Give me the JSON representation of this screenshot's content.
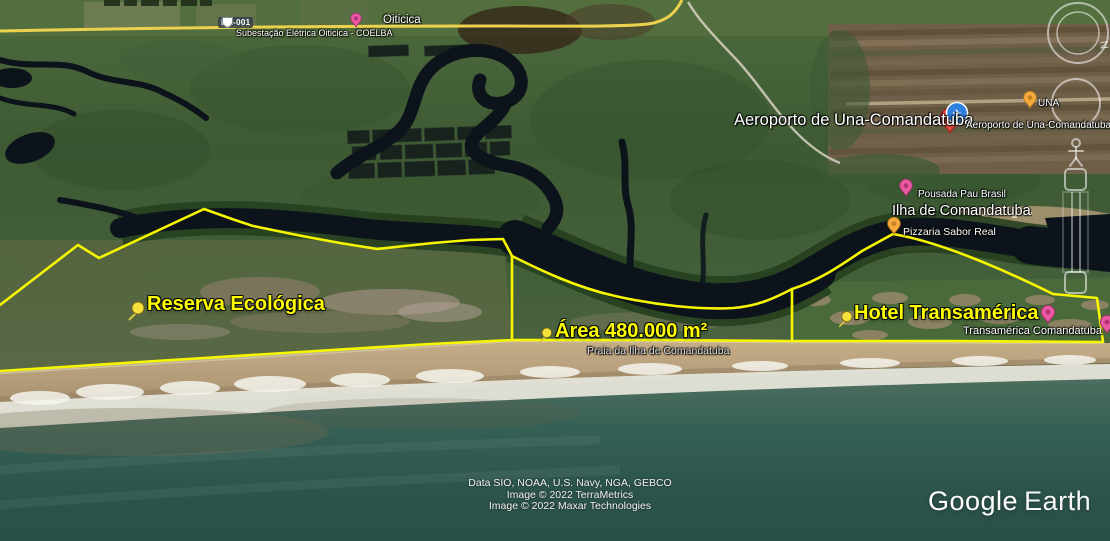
{
  "labels": {
    "road_shield": "BA-001",
    "substation": "Subestação Elétrica Oiticica - COELBA",
    "oiticica": "Oiticica",
    "airport_large": "Aeroporto de Una-Comandatuba",
    "airport_small": "Aeroporto de Una-Comandatuba",
    "una": "UNA",
    "pousada": "Pousada Pau Brasil",
    "ilha": "Ilha de Comandatuba",
    "pizzaria": "Pizzaria Sabor Real",
    "reserva": "Reserva Ecológica",
    "area": "Área 480.000 m²",
    "praia": "Praia da Ilha de Comandatuba",
    "hotel": "Hotel Transamérica",
    "transamerica": "Transamérica Comandatuba"
  },
  "attribution": {
    "line1": "Data SIO, NOAA, U.S. Navy, NGA, GEBCO",
    "line2": "Image © 2022 TerraMetrics",
    "line3": "Image © 2022 Maxar Technologies"
  },
  "branding": {
    "google": "Google",
    "earth": "Earth"
  },
  "controls": {
    "compass_north": "N"
  },
  "icons": {
    "airport_glyph": "✈"
  },
  "colors": {
    "parcel_outline": "#f6f600",
    "label_yellow": "#ffff00",
    "road_yellow": "#ecd14e",
    "pin_pink": "#ea5aa0",
    "pin_amber": "#f5a93d",
    "pin_red": "#e34b3e",
    "pin_blue": "#2f7fe0",
    "river_water": "#0c131a",
    "ocean": "#2c544b"
  }
}
